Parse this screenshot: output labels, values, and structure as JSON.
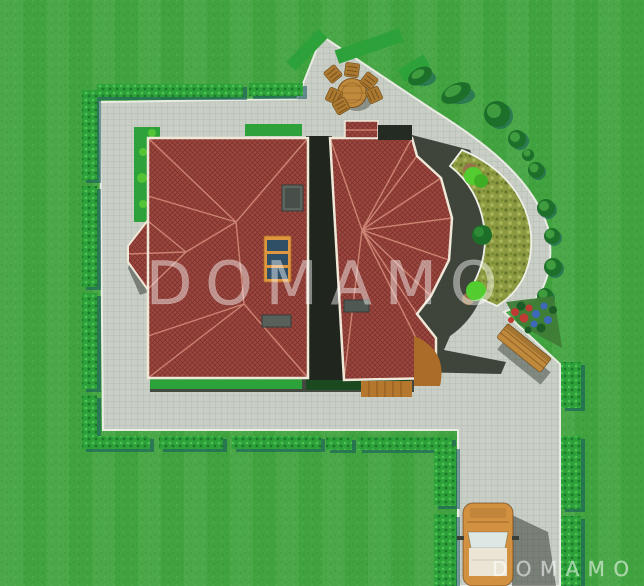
{
  "scene": {
    "type": "3d-site-plan-top-view",
    "watermark": {
      "center_text": "DOMAMO",
      "bottom_text": "DOMAMO"
    },
    "colors": {
      "grass": "#41a33f",
      "paving": "#c9cfc6",
      "roof": "#9c463e",
      "roof_ridge": "#d28b79",
      "hedge": "#2da23b",
      "crescent_bed": "#8d9a42",
      "shadow": "#2b3228",
      "wood_furniture": "#c08a3c",
      "car_body": "#d29140",
      "skylight_frame": "#e0953f",
      "skylight_glass": "#2f4f66"
    },
    "objects": {
      "lawn": "lawn",
      "paved_area": "paved patio and driveway",
      "house": "house with two red hip roofs",
      "patio_set": "round wooden table with six chairs",
      "crescent_bed": "crescent planting bed",
      "bench": "garden bench",
      "flower_bed": "flower bed",
      "car": "car on driveway",
      "hedges": "boundary hedges"
    }
  }
}
